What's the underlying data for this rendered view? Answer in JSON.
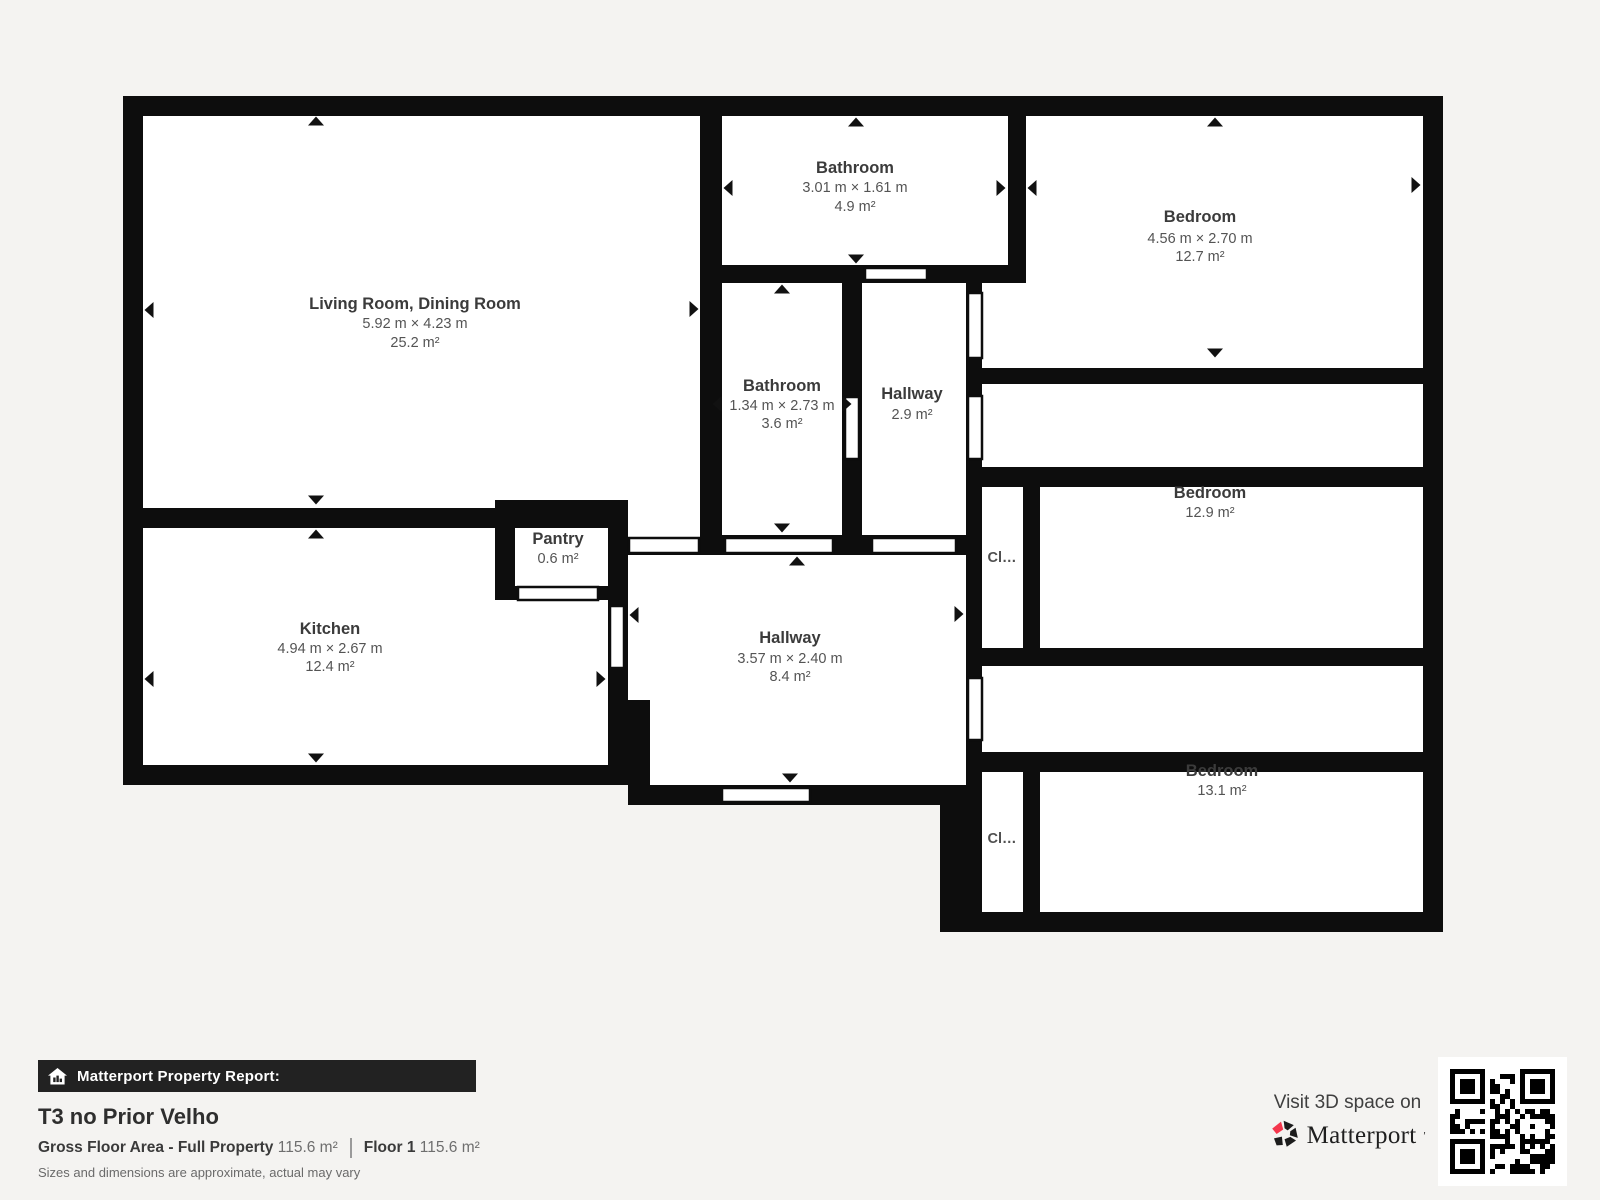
{
  "rooms": {
    "living": {
      "name": "Living Room, Dining Room",
      "dims": "5.92 m × 4.23 m",
      "area": "25.2 m²"
    },
    "bath_top": {
      "name": "Bathroom",
      "dims": "3.01 m × 1.61 m",
      "area": "4.9 m²"
    },
    "bed_top": {
      "name": "Bedroom",
      "dims": "4.56 m × 2.70 m",
      "area": "12.7 m²"
    },
    "bath_small": {
      "name": "Bathroom",
      "dims": "1.34 m × 2.73 m",
      "area": "3.6 m²"
    },
    "hall_small": {
      "name": "Hallway",
      "area": "2.9 m²"
    },
    "bed_mid": {
      "name": "Bedroom",
      "area": "12.9 m²"
    },
    "kitchen": {
      "name": "Kitchen",
      "dims": "4.94 m × 2.67 m",
      "area": "12.4 m²"
    },
    "pantry": {
      "name": "Pantry",
      "area": "0.6 m²"
    },
    "hall_main": {
      "name": "Hallway",
      "dims": "3.57 m × 2.40 m",
      "area": "8.4 m²"
    },
    "bed_bottom": {
      "name": "Bedroom",
      "area": "13.1 m²"
    },
    "closet_mid": {
      "label": "Cl…"
    },
    "closet_bottom": {
      "label": "Cl…"
    }
  },
  "report": {
    "bar_label": "Matterport Property Report:",
    "title": "T3 no Prior Velho",
    "gfa_label": "Gross Floor Area - Full Property",
    "gfa_value": "115.6 m²",
    "floor_label": "Floor 1",
    "floor_value": "115.6 m²",
    "disclaimer": "Sizes and dimensions are approximate, actual may vary"
  },
  "promo": {
    "visit_label": "Visit 3D space on",
    "brand": "Matterport"
  },
  "colors": {
    "background": "#f4f3f1",
    "wall": "#0d0d0d",
    "room": "#ffffff",
    "brand_pink": "#f4364c",
    "bar_background": "#222222"
  }
}
